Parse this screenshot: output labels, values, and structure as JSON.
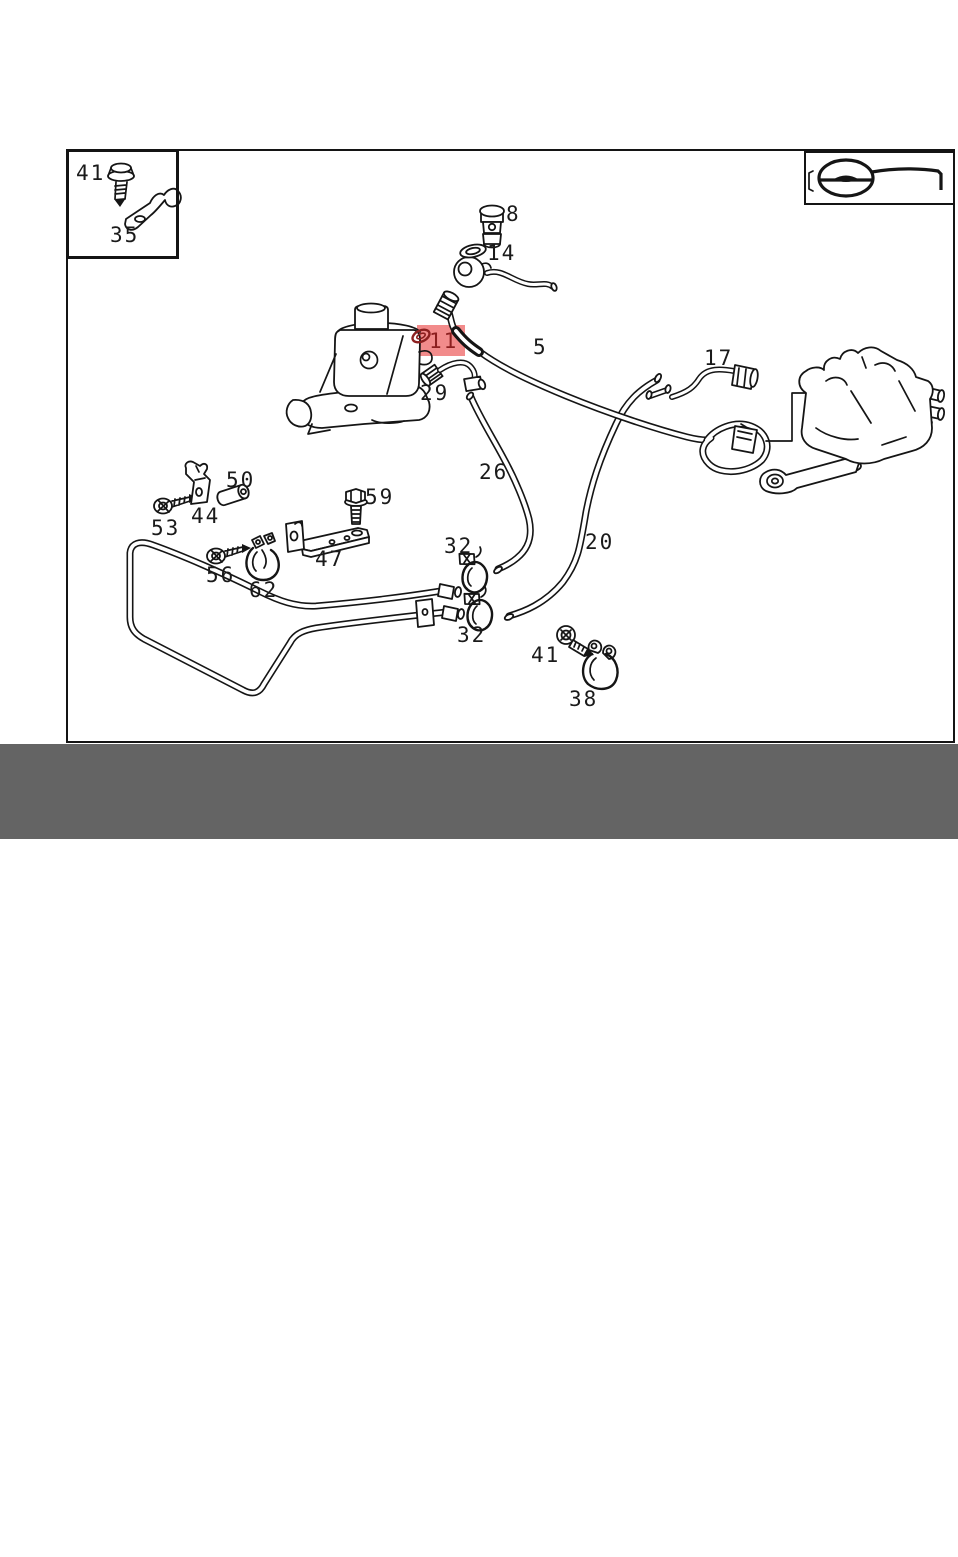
{
  "footer": {
    "brand_and_part": "MERCEDES BENZ - A0199977348",
    "sheet_ref": "N - 11",
    "bg": "#646464",
    "text_color": "#ffffff"
  },
  "legend": {
    "icon": "steering-wheel"
  },
  "diagram": {
    "highlight_color": "#f28b8b",
    "highlight_text_color": "#8c1f1f",
    "highlight_box": {
      "x": 417,
      "y": 325,
      "w": 48,
      "h": 31
    },
    "highlighted_part": "11",
    "labels": [
      {
        "text": "41",
        "x": 76,
        "y": 162
      },
      {
        "text": "35",
        "x": 110,
        "y": 224
      },
      {
        "text": "8",
        "x": 506,
        "y": 203
      },
      {
        "text": "14",
        "x": 487,
        "y": 242
      },
      {
        "text": "11",
        "x": 429,
        "y": 330,
        "highlight": true
      },
      {
        "text": "29",
        "x": 420,
        "y": 382
      },
      {
        "text": "5",
        "x": 533,
        "y": 336
      },
      {
        "text": "17",
        "x": 704,
        "y": 347
      },
      {
        "text": "26",
        "x": 479,
        "y": 461
      },
      {
        "text": "20",
        "x": 585,
        "y": 531
      },
      {
        "text": "50",
        "x": 226,
        "y": 469
      },
      {
        "text": "44",
        "x": 191,
        "y": 505
      },
      {
        "text": "53",
        "x": 151,
        "y": 517
      },
      {
        "text": "56",
        "x": 206,
        "y": 564
      },
      {
        "text": "62",
        "x": 249,
        "y": 579
      },
      {
        "text": "47",
        "x": 315,
        "y": 548
      },
      {
        "text": "59",
        "x": 365,
        "y": 486
      },
      {
        "text": "32",
        "x": 444,
        "y": 535
      },
      {
        "text": "32",
        "x": 457,
        "y": 624
      },
      {
        "text": "41",
        "x": 531,
        "y": 644
      },
      {
        "text": "38",
        "x": 569,
        "y": 688
      }
    ]
  }
}
